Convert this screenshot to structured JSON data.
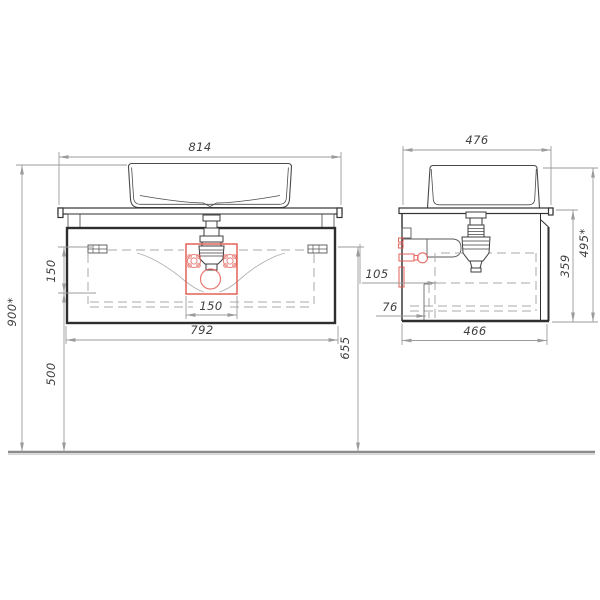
{
  "drawing": {
    "type": "technical-drawing",
    "subject": "wall-hung vanity cabinet with countertop basin, front and side views"
  },
  "dims": {
    "front_width_total": "814",
    "front_height_total": "900*",
    "front_top_offset": "150",
    "front_bottom_height": "500",
    "front_right_height": "655",
    "front_drain_zone_width": "150",
    "front_cabinet_width": "792",
    "side_depth_total": "476",
    "side_drain_depth_offset": "105",
    "side_supply_depth_offset": "76",
    "side_cabinet_depth": "466",
    "side_cabinet_height": "359",
    "side_unit_height": "495*"
  },
  "colors": {
    "line_dark": "#303030",
    "line_mid": "#4a4a4a",
    "dim_gray": "#9b9b9b",
    "dash_gray": "#a8a8a8",
    "accent_red": "#e2564d",
    "floor_gray": "#8c8c8c"
  }
}
